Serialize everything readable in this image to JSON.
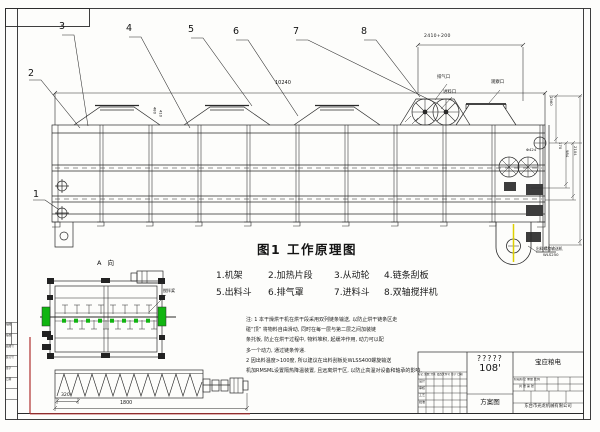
{
  "drawing": {
    "figure_title": "图1  工作原理图",
    "parts": [
      "1.机架",
      "2.加热片段",
      "3.从动轮",
      "4.链条刮板",
      "5.出料斗",
      "6.排气罩",
      "7.进料斗",
      "8.双轴搅拌机"
    ],
    "balloons": [
      "1",
      "2",
      "3",
      "4",
      "5",
      "6",
      "7",
      "8"
    ],
    "notes": [
      "注: 1 本干燥烘干机在烘干段采用双列链条输送, 以防止烘干链条区走",
      "碰“顶” 将物料自由滑动, 同时在每一层与第二层之间加装链",
      "条托板, 防止在烘干过程中, 物料堆积, 起缓冲作用, 动力可以配",
      "多一个动力, 通过链条传递.",
      "2 因出料温度>100度, 所以建议在出料刮板处WLSS400螺旋输送",
      "机加RMSML设置隔热降温装置, 且远离烘干区, 以防止高温对设备和轴承的影响."
    ],
    "dimensions": {
      "top_span": "2410+200",
      "overall_length": "10240",
      "left_a": "480",
      "left_b": "410",
      "phi": "Φ424",
      "v1560": "1560",
      "v170": "170",
      "v984": "984",
      "v2104": "2104",
      "conveyor_pitch": "320",
      "conveyor_length": "1800"
    },
    "labels": {
      "view_a": "A 向",
      "exhaust_port": "排气口",
      "feed_port": "进料口",
      "inspection_port": "观察口",
      "mixer_paddle": "搅拌桨",
      "discharge_line1": "出料螺旋输送机",
      "discharge_line2": "WLS250"
    },
    "title_block": {
      "model_unknown": "?????",
      "model_no": "108'",
      "doc_type": "方案图",
      "client": "宝应粮电",
      "company": "东台市光龙机械有限公司",
      "left_header": "标记 处数 分区 更改文件号 签字 日期",
      "row_design": "设计",
      "row_check": "审核",
      "row_process": "工艺",
      "row_approve": "批准",
      "stage_row": "阶段标记 重量 比例",
      "sheet_row": "共 张 第 张"
    },
    "rev_strip": [
      "描图",
      "描校",
      "底图号",
      "装订号",
      "签字",
      "日期"
    ],
    "colors": {
      "line": "#2a2a2a",
      "green_part": "#11b511",
      "yellow_centerline": "#ddcf00",
      "red_mark": "#b03030"
    }
  }
}
